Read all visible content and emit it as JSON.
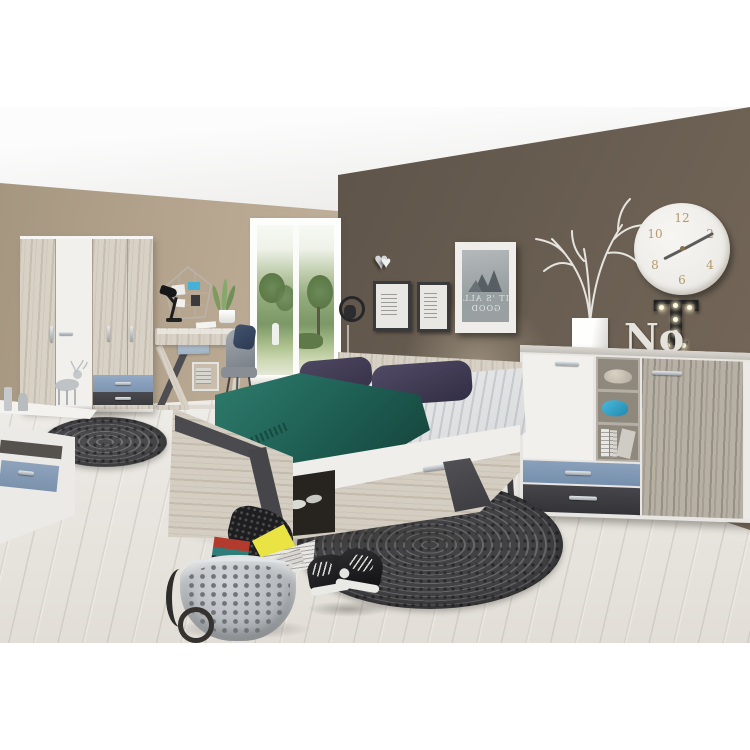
{
  "page": {
    "background": "#ffffff",
    "type": "furniture-product-photo",
    "subject": "youth bedroom set with wardrobe, desk, bed, nightstand and sideboard"
  },
  "palette": {
    "wall_left": "#b3a38d",
    "wall_accent": "#5f554a",
    "ceiling": "#f4f4f3",
    "floor": "#e9e6e1",
    "sand_oak": "#d8d1c5",
    "grey_oak": "#b7b0a5",
    "white_furniture": "#f1f0ed",
    "accent_blue": "#8aa0bc",
    "accent_dark_grey": "#45464a",
    "teal_blanket": "#1f6358",
    "pillow_purple": "#433d54",
    "rug_grey": "#5c5c5f"
  },
  "decor": {
    "clock": {
      "numerals": [
        "12",
        "2",
        "4",
        "6",
        "8",
        "10"
      ],
      "time_shown": "8:10"
    },
    "poster_large": {
      "line1": "IT 'S ALL",
      "line2": "GOOD"
    },
    "marquee_letters": {
      "white": "No",
      "black": "T"
    }
  }
}
